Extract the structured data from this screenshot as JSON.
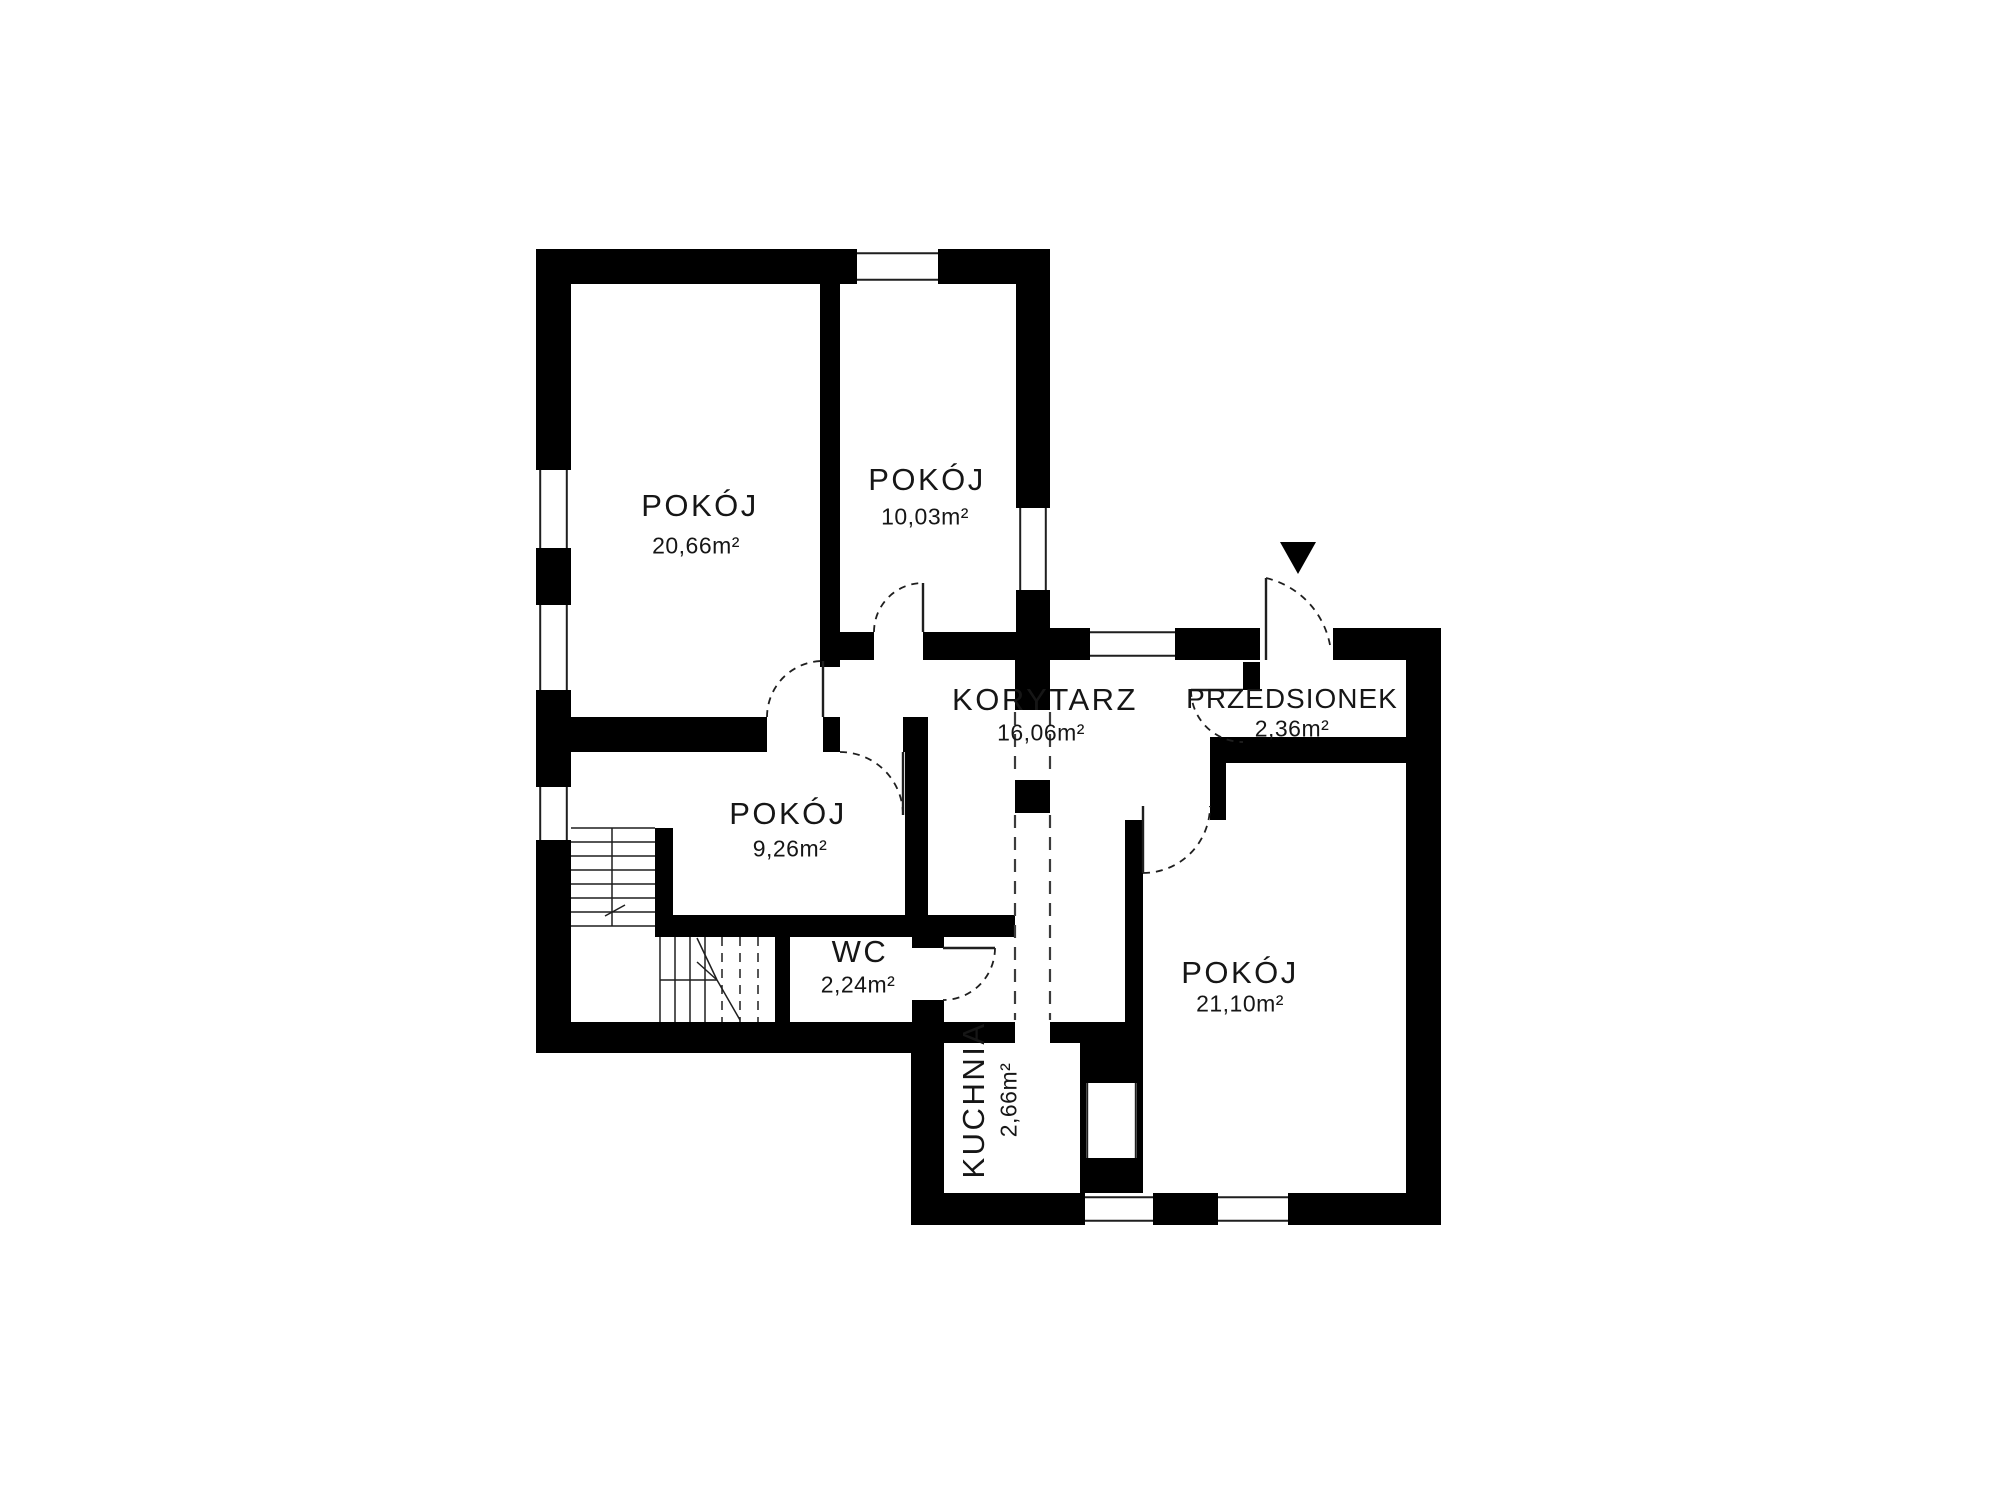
{
  "plan": {
    "background": "#ffffff",
    "wall_color": "#000000",
    "line_color": "#1f1f1f",
    "dash_color": "#3c3c3c",
    "rooms": [
      {
        "id": "pokoj-1",
        "name": "POKÓJ",
        "area": "20,66m²"
      },
      {
        "id": "pokoj-2",
        "name": "POKÓJ",
        "area": "10,03m²"
      },
      {
        "id": "korytarz",
        "name": "KORYTARZ",
        "area": "16,06m²"
      },
      {
        "id": "przedsionek",
        "name": "PRZEDSIONEK",
        "area": "2,36m²"
      },
      {
        "id": "pokoj-3",
        "name": "POKÓJ",
        "area": "9,26m²"
      },
      {
        "id": "wc",
        "name": "WC",
        "area": "2,24m²"
      },
      {
        "id": "kuchnia",
        "name": "KUCHNIA",
        "area": "2,66m²"
      },
      {
        "id": "pokoj-4",
        "name": "POKÓJ",
        "area": "21,10m²"
      }
    ],
    "geometry": {
      "walls": [
        [
          536,
          249,
          321,
          35
        ],
        [
          938,
          249,
          112,
          35
        ],
        [
          536,
          249,
          35,
          221
        ],
        [
          536,
          548,
          35,
          57
        ],
        [
          536,
          690,
          35,
          97
        ],
        [
          536,
          840,
          35,
          213
        ],
        [
          820,
          284,
          20,
          383
        ],
        [
          536,
          717,
          231,
          35
        ],
        [
          823,
          717,
          17,
          35
        ],
        [
          903,
          717,
          25,
          35
        ],
        [
          905,
          752,
          23,
          163
        ],
        [
          840,
          632,
          34,
          28
        ],
        [
          923,
          632,
          93,
          28
        ],
        [
          1016,
          284,
          34,
          224
        ],
        [
          1016,
          590,
          34,
          70
        ],
        [
          1050,
          628,
          40,
          32
        ],
        [
          1175,
          628,
          85,
          32
        ],
        [
          1333,
          628,
          73,
          32
        ],
        [
          1406,
          628,
          35,
          597
        ],
        [
          1243,
          662,
          17,
          28
        ],
        [
          1210,
          737,
          196,
          26
        ],
        [
          1210,
          763,
          16,
          57
        ],
        [
          1125,
          820,
          18,
          217
        ],
        [
          1080,
          1037,
          63,
          156
        ],
        [
          944,
          1022,
          71,
          21
        ],
        [
          1050,
          1022,
          93,
          21
        ],
        [
          655,
          915,
          360,
          22
        ],
        [
          912,
          937,
          32,
          11
        ],
        [
          912,
          1000,
          32,
          22
        ],
        [
          655,
          828,
          18,
          87
        ],
        [
          775,
          937,
          15,
          85
        ],
        [
          536,
          1022,
          408,
          31
        ],
        [
          911,
          1053,
          33,
          172
        ],
        [
          944,
          1193,
          141,
          32
        ],
        [
          1153,
          1193,
          65,
          32
        ],
        [
          1288,
          1193,
          118,
          32
        ],
        [
          1015,
          660,
          35,
          50
        ],
        [
          1015,
          780,
          35,
          33
        ]
      ],
      "windows": [
        [
          857,
          252,
          81,
          29,
          "h"
        ],
        [
          539,
          470,
          29,
          78,
          "v"
        ],
        [
          539,
          605,
          29,
          85,
          "v"
        ],
        [
          539,
          787,
          29,
          53,
          "v"
        ],
        [
          1019,
          508,
          28,
          82,
          "v"
        ],
        [
          1090,
          631,
          85,
          26,
          "h"
        ],
        [
          1086,
          1083,
          51,
          75,
          "v"
        ],
        [
          1085,
          1196,
          68,
          26,
          "h"
        ],
        [
          1218,
          1196,
          70,
          26,
          "h"
        ]
      ],
      "doors": [
        {
          "leaf": [
            823,
            717,
            823,
            661
          ],
          "arc": [
            767,
            717,
            56,
            823,
            661,
            1
          ]
        },
        {
          "leaf": [
            903,
            752,
            903,
            815
          ],
          "arc": [
            840,
            752,
            63,
            903,
            815,
            1
          ]
        },
        {
          "leaf": [
            923,
            632,
            923,
            583
          ],
          "arc": [
            874,
            632,
            49,
            923,
            583,
            1
          ]
        },
        {
          "leaf": [
            1266,
            660,
            1266,
            578
          ],
          "arc": [
            1266,
            578,
            85,
            1330,
            645,
            1
          ]
        },
        {
          "leaf": [
            1243,
            690,
            1191,
            690
          ],
          "arc": [
            1191,
            690,
            52,
            1243,
            742,
            0
          ]
        },
        {
          "leaf": [
            1143,
            806,
            1143,
            873
          ],
          "arc": [
            1143,
            873,
            67,
            1210,
            806,
            0
          ]
        },
        {
          "leaf": [
            943,
            948,
            995,
            948
          ],
          "arc": [
            995,
            948,
            52,
            943,
            1000,
            1
          ]
        }
      ],
      "dashed_openings": [
        [
          1015,
          712,
          1015,
          778
        ],
        [
          1015,
          815,
          1015,
          1020
        ],
        [
          1050,
          712,
          1050,
          778
        ],
        [
          1050,
          815,
          1050,
          1020
        ]
      ],
      "stair_lines_solid": [
        [
          571,
          828,
          655,
          828
        ],
        [
          571,
          842,
          655,
          842
        ],
        [
          571,
          856,
          655,
          856
        ],
        [
          571,
          870,
          655,
          870
        ],
        [
          571,
          884,
          655,
          884
        ],
        [
          571,
          898,
          655,
          898
        ],
        [
          571,
          912,
          655,
          912
        ],
        [
          571,
          926,
          655,
          926
        ],
        [
          612,
          828,
          612,
          926
        ],
        [
          605,
          916,
          625,
          905
        ],
        [
          660,
          937,
          660,
          1022
        ],
        [
          675,
          937,
          675,
          1022
        ],
        [
          690,
          937,
          690,
          1022
        ],
        [
          705,
          937,
          705,
          1022
        ],
        [
          660,
          980,
          717,
          980
        ],
        [
          697,
          938,
          717,
          980
        ],
        [
          697,
          962,
          717,
          980
        ],
        [
          717,
          980,
          740,
          1020
        ]
      ],
      "stair_lines_dashed": [
        [
          722,
          937,
          722,
          1022
        ],
        [
          740,
          937,
          740,
          1022
        ],
        [
          758,
          937,
          758,
          1022
        ]
      ],
      "entrance_arrow": "1280,542 1316,542 1298,574"
    }
  }
}
